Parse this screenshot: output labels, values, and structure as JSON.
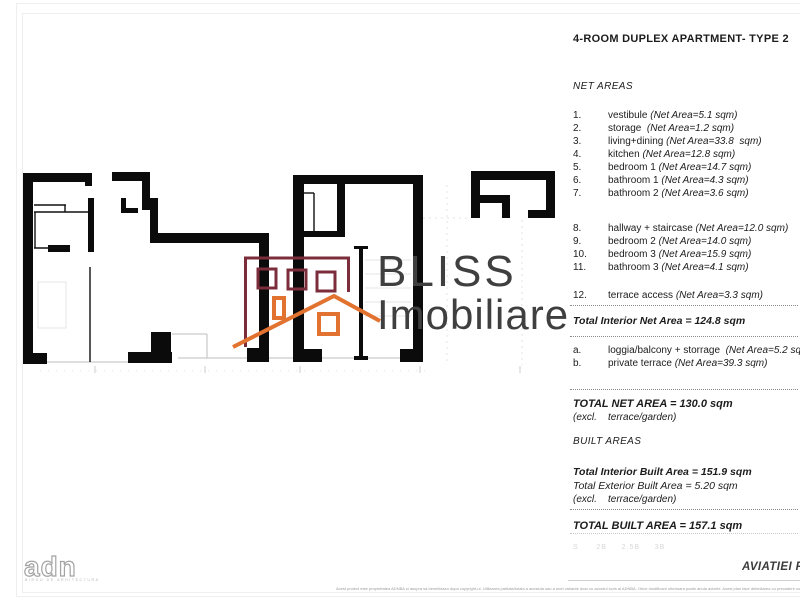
{
  "title": "4-ROOM DUPLEX APARTMENT- TYPE 2",
  "net_areas": {
    "heading": "NET AREAS",
    "items": [
      {
        "num": "1.",
        "name": "vestibule ",
        "area": "(Net Area=5.1 sqm)"
      },
      {
        "num": "2.",
        "name": "storage  ",
        "area": "(Net Area=1.2 sqm)"
      },
      {
        "num": "3.",
        "name": "living+dining ",
        "area": "(Net Area=33.8  sqm)"
      },
      {
        "num": "4.",
        "name": "kitchen ",
        "area": "(Net Area=12.8 sqm)"
      },
      {
        "num": "5.",
        "name": "bedroom 1 ",
        "area": "(Net Area=14.7 sqm)"
      },
      {
        "num": "6.",
        "name": "bathroom 1 ",
        "area": "(Net Area=4.3 sqm)"
      },
      {
        "num": "7.",
        "name": "bathroom 2 ",
        "area": "(Net Area=3.6 sqm)"
      },
      {
        "num": "8.",
        "name": "hallway + staircase ",
        "area": "(Net Area=12.0 sqm)"
      },
      {
        "num": "9.",
        "name": "bedroom 2 ",
        "area": "(Net Area=14.0 sqm)"
      },
      {
        "num": "10.",
        "name": "bedroom 3 ",
        "area": "(Net Area=15.9 sqm)"
      },
      {
        "num": "11.",
        "name": "bathroom 3 ",
        "area": "(Net Area=4.1 sqm)"
      },
      {
        "num": "12.",
        "name": "terrace access ",
        "area": "(Net Area=3.3 sqm)"
      }
    ],
    "total_interior": "Total Interior Net Area = 124.8 sqm",
    "extras": [
      {
        "num": "a.",
        "name": "loggia/balcony + storrage  ",
        "area": "(Net Area=5.2 sqm)"
      },
      {
        "num": "b.",
        "name": "private terrace ",
        "area": "(Net Area=39.3 sqm)"
      }
    ],
    "total": "TOTAL NET AREA = 130.0 sqm",
    "total_note": "(excl.    terrace/garden)"
  },
  "built_areas": {
    "heading": "BUILT AREAS",
    "interior": "Total Interior Built Area = 151.9 sqm",
    "exterior": "Total Exterior Built Area = 5.20 sqm",
    "note": "(excl.    terrace/garden)",
    "total": "TOTAL BUILT AREA = 157.1 sqm"
  },
  "type_tabs": "S      2B     2.5B     3B",
  "watermark": {
    "line1": "BLISS",
    "line2": "Imobiliare",
    "maroon": "#7b2d3c",
    "orange": "#e27230",
    "text_color": "#3f3f3f"
  },
  "footer": {
    "architect_logo": "adn",
    "architect_sub": "BIROU DE ARHITECTURA",
    "project_label": "AVIATIEI PA",
    "disclaimer": "Acest proiect este proprietatea ADNBA si asupra sa beneficiaza dupa copyright-ul. Utilizarea partiala/totala a acestuia sau a unei variante doar cu acordul scris al ADNBA.   Orice modificare ulterioara poate anula avizele. Acest plan face delimitarea cu precadere cu doua pozitii tehnice, si prezinta un produs cu erori."
  }
}
